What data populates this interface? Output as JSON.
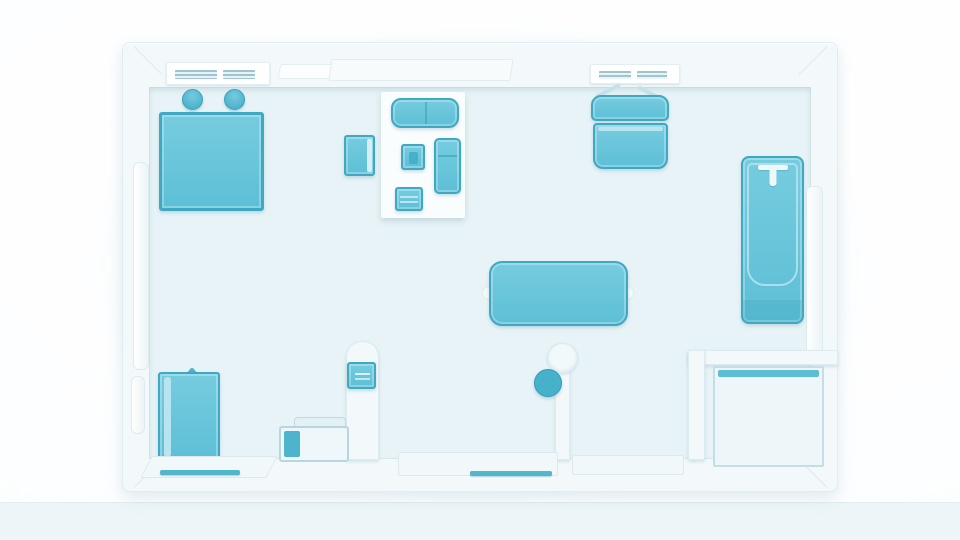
{
  "scene": {
    "description": "Top-down 3D rendered floor plan of a studio apartment, drawn in white walls and teal furniture on a pale blue floor; no visible text or UI chrome",
    "view": "top-down floor plan illustration"
  },
  "palette": {
    "furniture_teal": "#63c2d8",
    "furniture_border": "#3fa8c3",
    "floor": "#e7f3f6",
    "walls": "#f3f9fb",
    "wall_edge": "#d9e8ed",
    "page_bottom_band": "#edf5f8",
    "accent_white": "#fbfdfe"
  },
  "furniture": {
    "square_mat": {
      "label": "Large square bed mat"
    },
    "stool_left": {
      "label": "Round stool"
    },
    "stool_right": {
      "label": "Round stool"
    },
    "rug": {
      "label": "White area rug"
    },
    "loveseat": {
      "label": "Two-seat sofa"
    },
    "armchair": {
      "label": "Armchair"
    },
    "coffee_table": {
      "label": "Coffee table"
    },
    "lounge_chair": {
      "label": "Lounge chair"
    },
    "media_console": {
      "label": "Media console"
    },
    "hanging_chair": {
      "label": "Wall-mounted hanging chair"
    },
    "bathtub": {
      "label": "Bathtub with faucet"
    },
    "dining_table": {
      "label": "Dining table"
    },
    "pillar_cap": {
      "label": "Round column cap"
    },
    "device_dot": {
      "label": "Round teal marker"
    },
    "wall_device": {
      "label": "Wall control panel"
    },
    "shower_tray": {
      "label": "Shower enclosure"
    },
    "tote_bag": {
      "label": "Tote bag"
    },
    "storage_chest": {
      "label": "Storage chest"
    },
    "vent_left": {
      "label": "Wall vent"
    },
    "vent_right": {
      "label": "Wall vent"
    },
    "window_top": {
      "label": "Window sill"
    },
    "window_left": {
      "label": "Side window"
    },
    "window_right": {
      "label": "Side window"
    },
    "threshold_left": {
      "label": "Door threshold"
    },
    "threshold_center": {
      "label": "Door threshold"
    }
  }
}
